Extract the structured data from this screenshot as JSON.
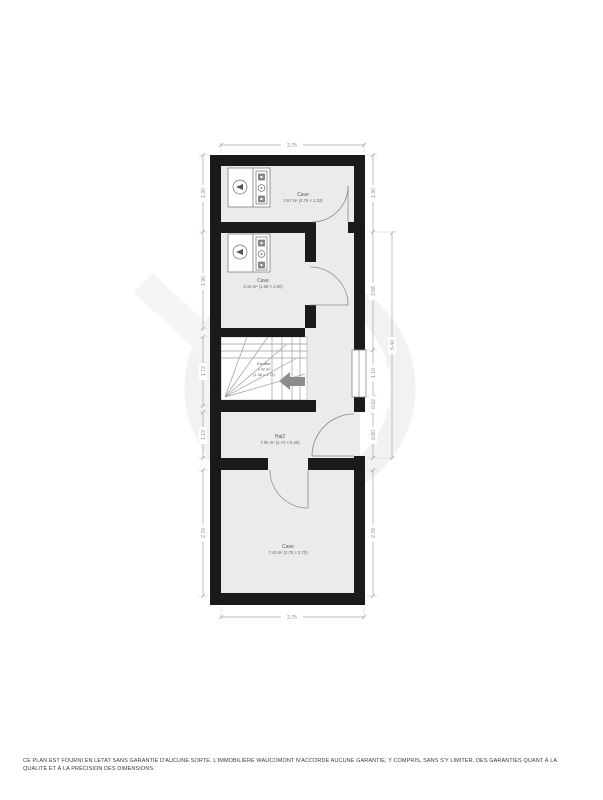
{
  "plan": {
    "rooms": [
      {
        "id": "cave-top",
        "name": "Cave",
        "area": "3.67 m² (2.76 × 1.33)"
      },
      {
        "id": "cave-mid",
        "name": "Cave",
        "area": "3.18 m² (1.68 × 1.90)"
      },
      {
        "id": "stairs",
        "name": "Escalier",
        "area": "2.42 m²",
        "dims": "(1.36 × 1.72)"
      },
      {
        "id": "hall",
        "name": "Hal2",
        "area": "7.05 m² (2.74 × 5.40)"
      },
      {
        "id": "cave-bottom",
        "name": "Cave",
        "area": "7.43 m² (2.75 × 2.70)"
      }
    ],
    "dimensions": {
      "top": "2.75",
      "bottom": "2.75",
      "left": [
        "1.30",
        "1.90",
        "1.72",
        "1.19",
        "2.70"
      ],
      "right": [
        "1.30",
        "2.68",
        "1.10",
        "0.62",
        "0.80",
        "2.70"
      ],
      "right_overall": "5.40"
    },
    "colors": {
      "wall": "#1a1a1a",
      "room_fill": "#ebebeb",
      "dim_line": "#a5a5a5",
      "dim_text": "#8a8a8a",
      "label_text": "#555555",
      "arrow": "#8c8c8c",
      "watermark": "#f2f2f2"
    }
  },
  "footer": {
    "line1": "CE PLAN EST FOURNI EN LETAT SANS GARANTIE D'AUCUNE SORTE. L'IMMOBILIÈRE WAUCOMONT N'ACCORDE AUCUNE GARANTIE, Y COMPRIS, SANS S'Y LIMITER, DES GARANTIES QUANT À LA",
    "line2": "QUALITÉ ET À LA PRÉCISION DES DIMENSIONS."
  }
}
